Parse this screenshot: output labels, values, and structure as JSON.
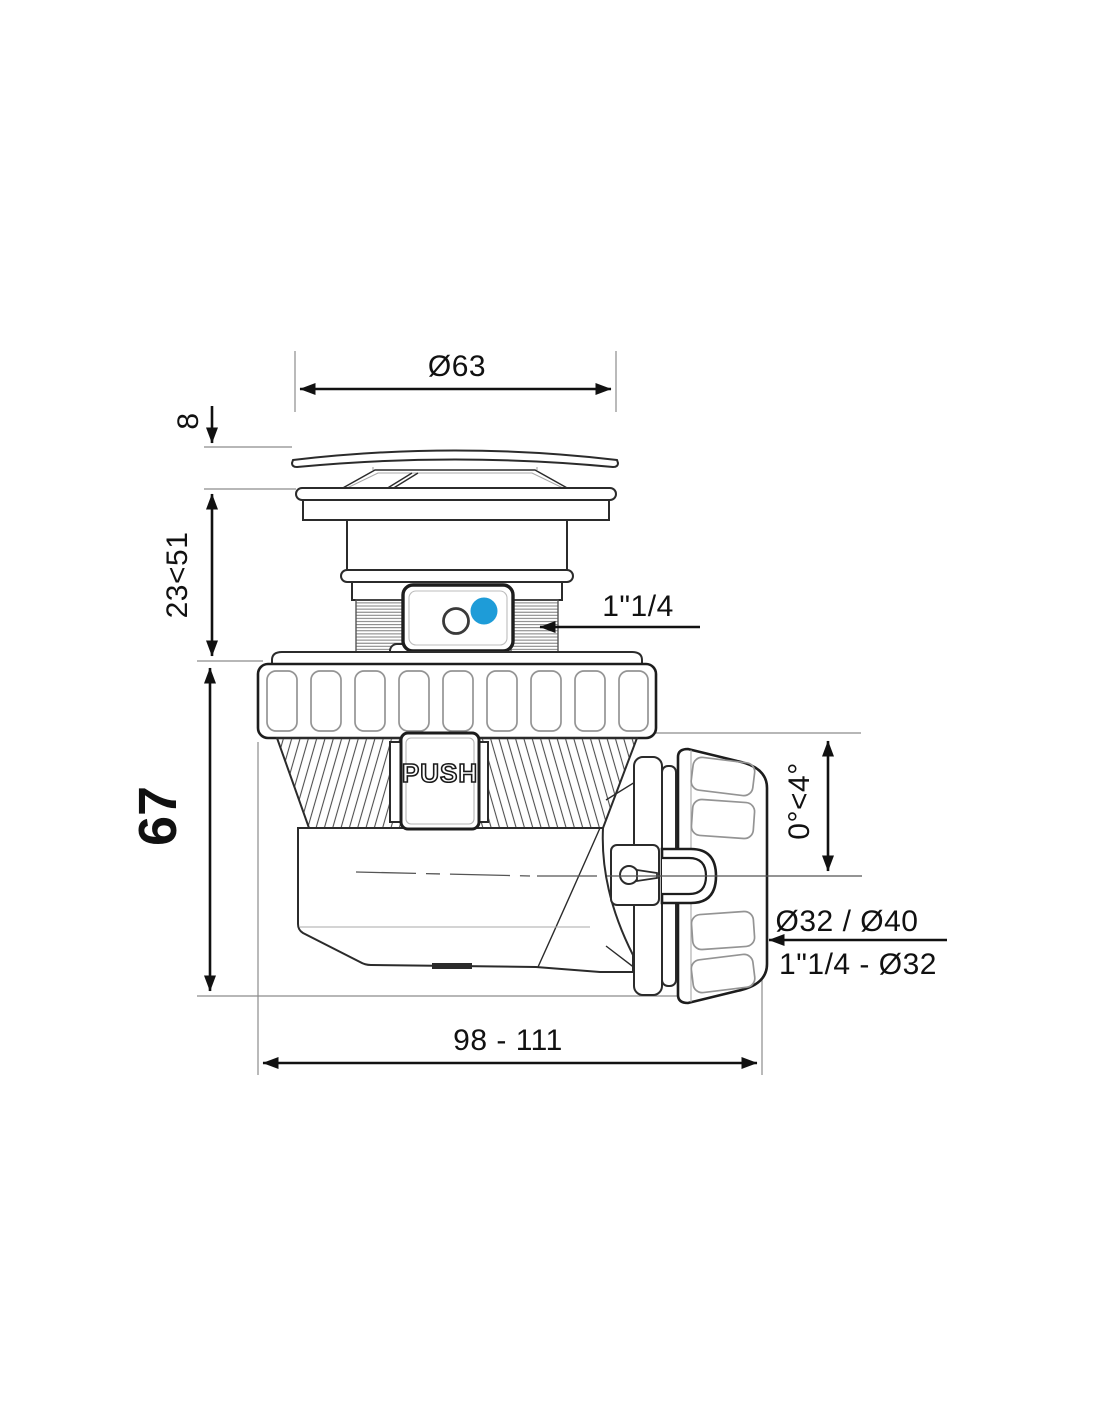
{
  "drawing": {
    "title": "tap-drain-trap-dimensional-drawing",
    "labels": {
      "cap_diameter": "Ø63",
      "cap_height": "8",
      "adjust_range": "23<51",
      "body_height": "67",
      "inlet_thread": "1\"1/4",
      "push": "PUSH",
      "outlet_angle": "0°<4°",
      "outlet_pipes": "Ø32 / Ø40",
      "outlet_nut": "1\"1/4 - Ø32",
      "overall_length": "98 - 111"
    },
    "colors": {
      "line": "#2b2b2b",
      "dimension": "#111111",
      "extension": "#8c8c8c",
      "accent_blue": "#1e9cd8",
      "background": "#ffffff"
    },
    "icons": {
      "open_indicator": "outlined-circle",
      "closed_indicator": "filled-blue-dot",
      "arrowheads": "filled-triangle"
    }
  }
}
